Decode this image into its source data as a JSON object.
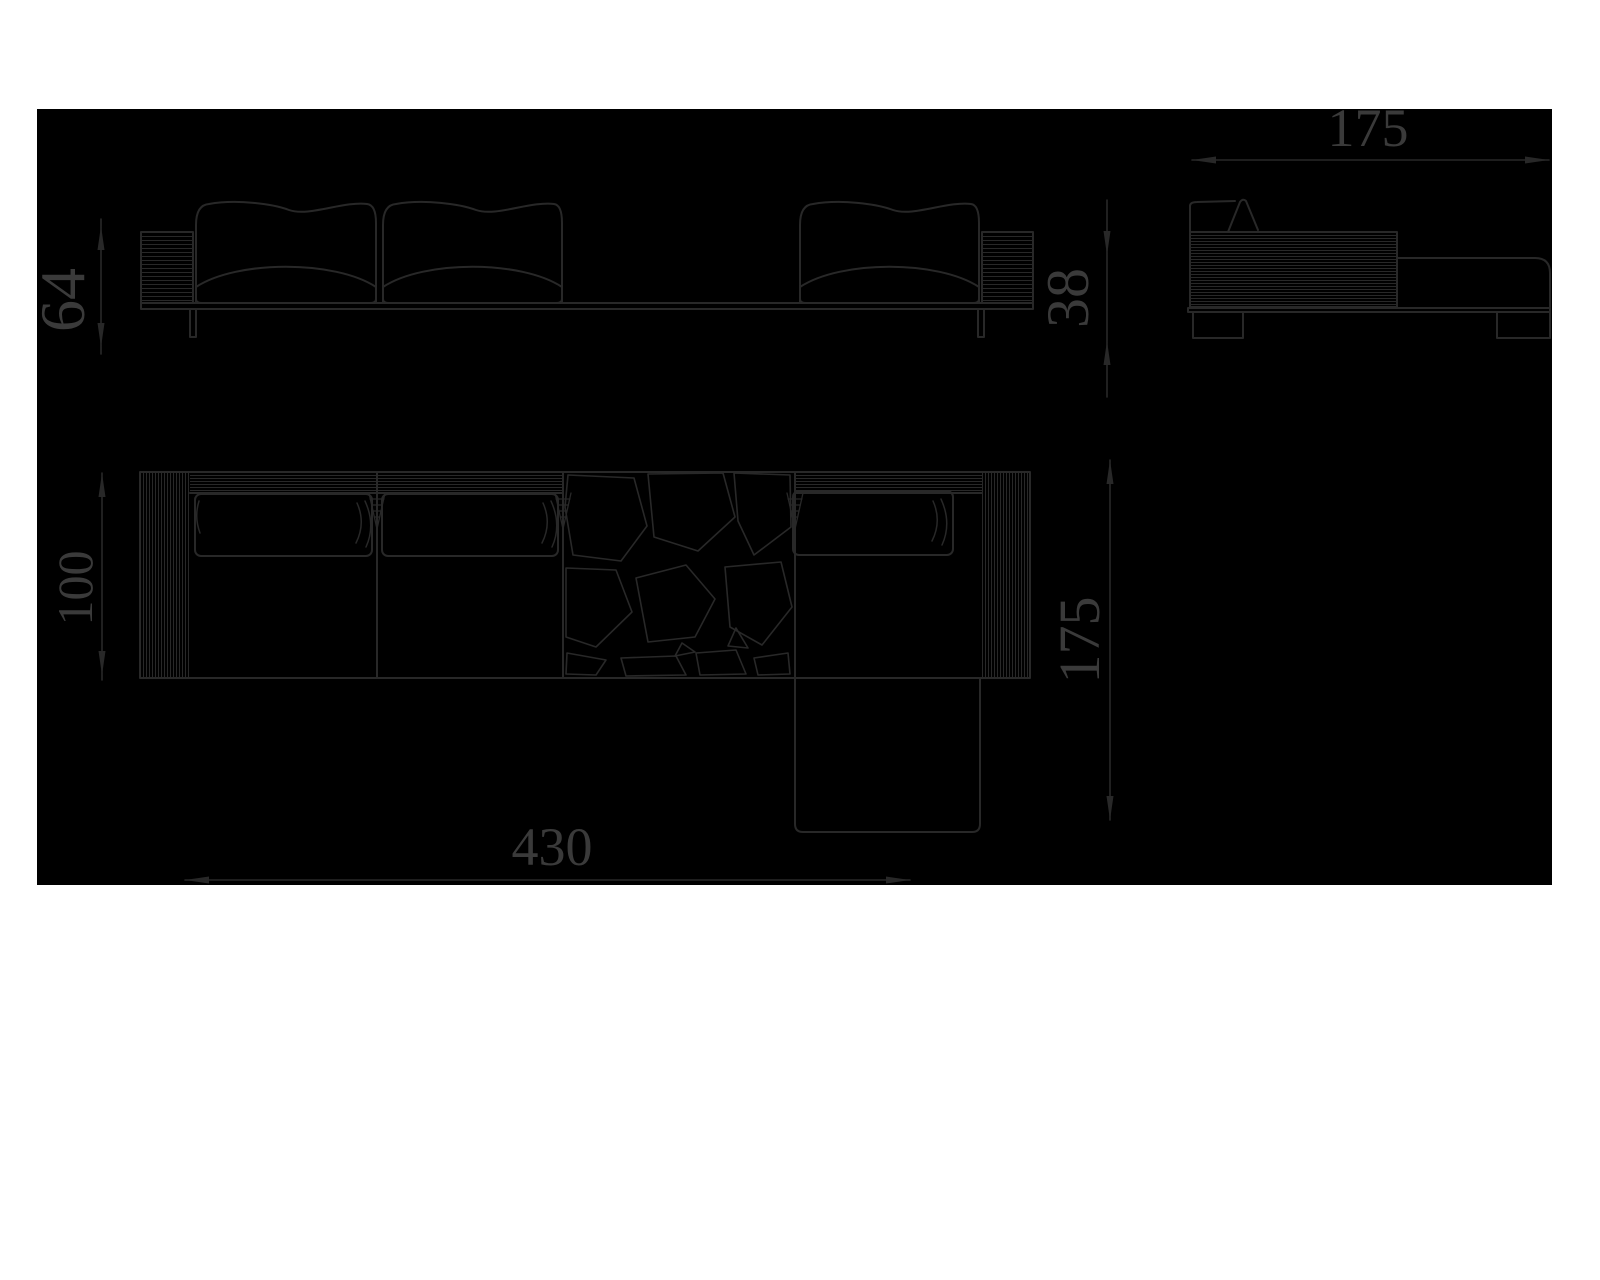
{
  "page": {
    "background": "#ffffff"
  },
  "drawing": {
    "type": "furniture technical drawing",
    "subject": "modular sofa with chaise longue - front elevation, side view and plan view",
    "canvas_background": "#000000",
    "line_color": "#282828",
    "text_color": "#3a3a3a",
    "dimensions": {
      "front_height": "64",
      "seat_height": "38",
      "side_depth": "175",
      "body_depth": "100",
      "plan_depth": "175",
      "total_width": "430"
    }
  }
}
